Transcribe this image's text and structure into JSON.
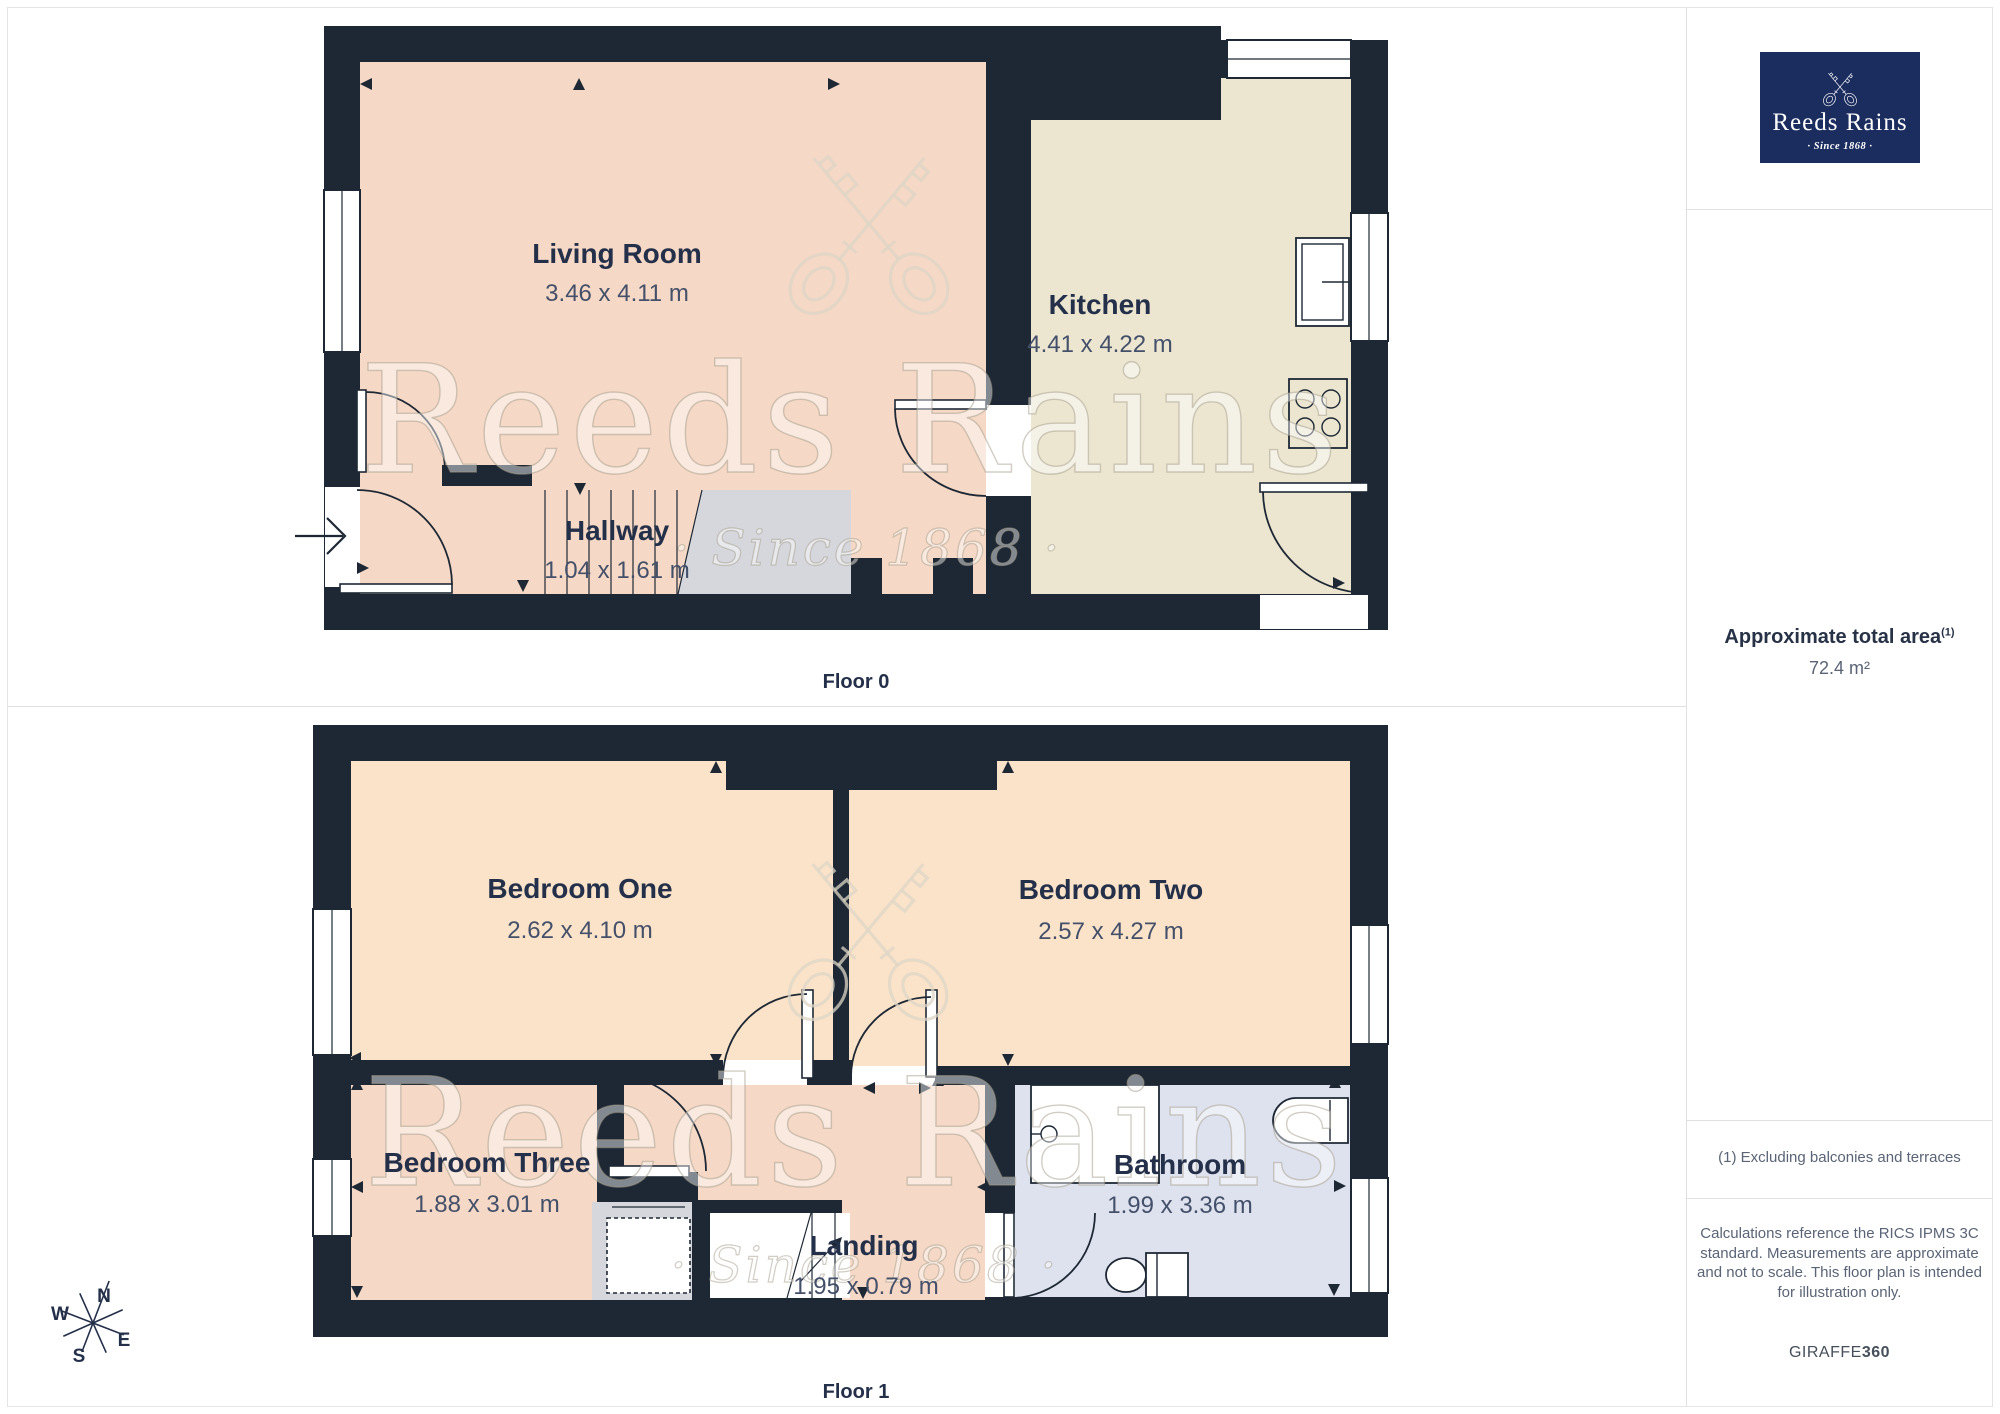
{
  "floors": [
    {
      "caption": "Floor 0",
      "rooms": [
        {
          "name": "Living Room",
          "dims": "3.46 x 4.11 m",
          "color": "#f5d8c5"
        },
        {
          "name": "Kitchen",
          "dims": "4.41 x 4.22 m",
          "color": "#ece6d1"
        },
        {
          "name": "Hallway",
          "dims": "1.04 x 1.61 m",
          "color": "#f5d8c5"
        }
      ]
    },
    {
      "caption": "Floor 1",
      "rooms": [
        {
          "name": "Bedroom One",
          "dims": "2.62 x 4.10 m",
          "color": "#fbe3c9"
        },
        {
          "name": "Bedroom Two",
          "dims": "2.57 x 4.27 m",
          "color": "#fbe3c9"
        },
        {
          "name": "Bedroom Three",
          "dims": "1.88 x 3.01 m",
          "color": "#f5d8c5"
        },
        {
          "name": "Bathroom",
          "dims": "1.99 x 3.36 m",
          "color": "#dee2ee"
        },
        {
          "name": "Landing",
          "dims": "1.95 x 0.79 m",
          "color": "#f5d8c5"
        }
      ]
    }
  ],
  "watermark": {
    "brand": "Reeds Rains",
    "since": "· Since 1868 ·"
  },
  "compass": {
    "n": "N",
    "e": "E",
    "s": "S",
    "w": "W"
  },
  "sidebar": {
    "logo": {
      "brand": "Reeds Rains",
      "since": "· Since 1868 ·"
    },
    "area_title": "Approximate total area",
    "area_footnote_marker": "(1)",
    "area_value": "72.4 m²",
    "footnote": "(1) Excluding balconies and terraces",
    "disclaimer": "Calculations reference the RICS IPMS 3C standard. Measurements are approximate and not to scale. This floor plan is intended for illustration only.",
    "brand_footer_name": "GIRAFFE",
    "brand_footer_suffix": "360"
  },
  "colors": {
    "wall": "#1e2835",
    "living_pink": "#f5d8c5",
    "kitchen_cream": "#ece6d1",
    "bedroom_peach": "#fbe3c9",
    "bathroom_blue": "#dee2ee",
    "stair_gray": "#d5d7dc",
    "logo_navy": "#1b2c5e",
    "divider": "#e0e0e0"
  }
}
